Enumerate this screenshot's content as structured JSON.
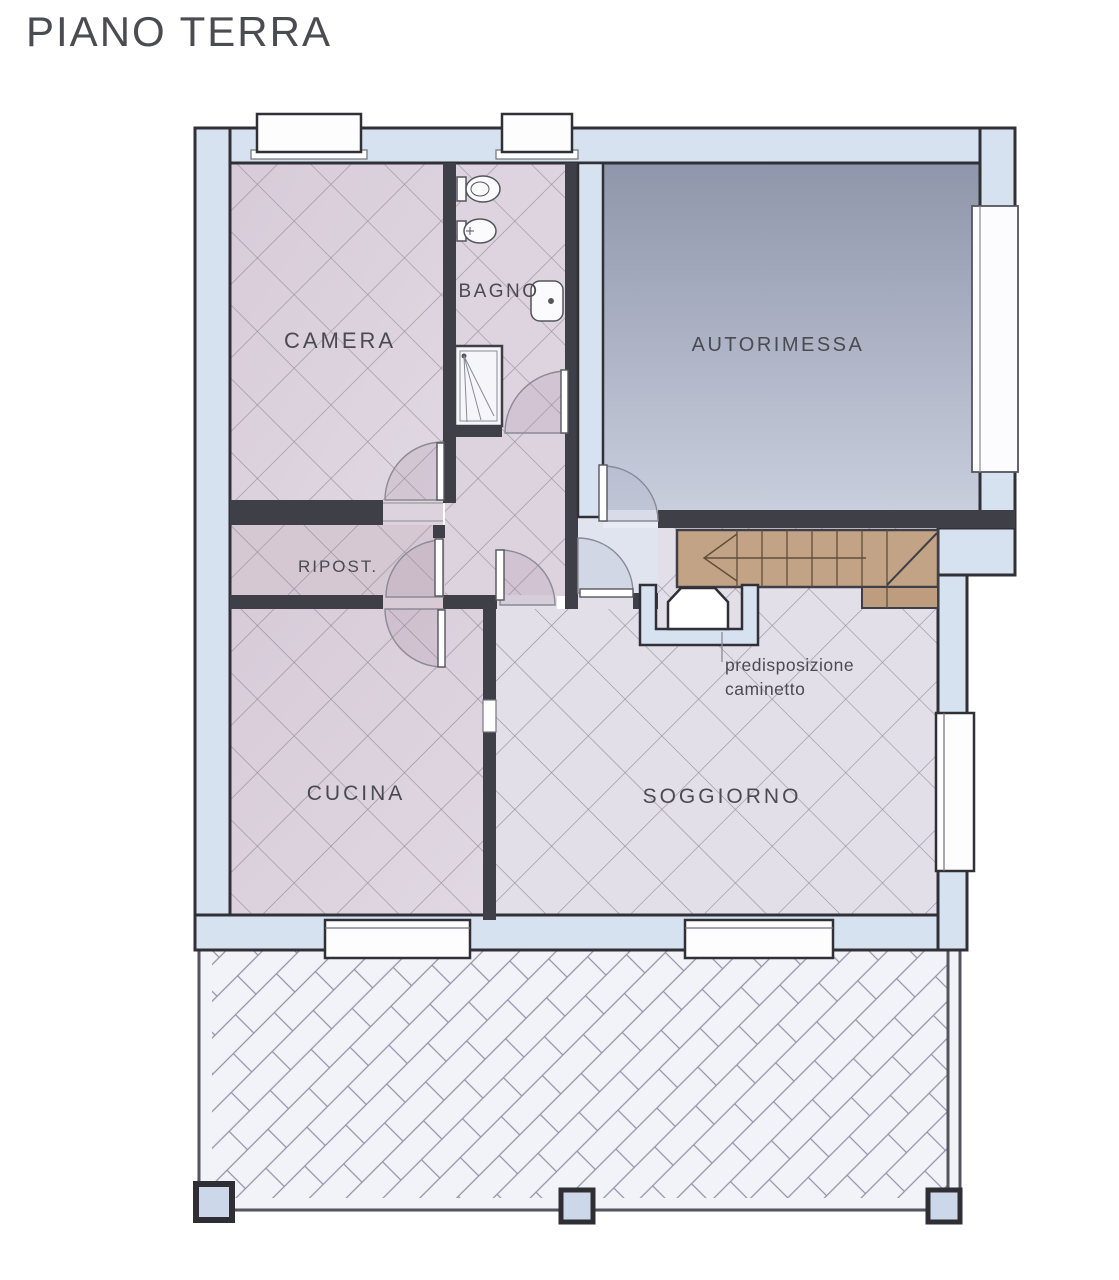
{
  "title": "PIANO TERRA",
  "floor_plan": {
    "rooms": {
      "camera": "CAMERA",
      "bagno": "BAGNO",
      "autorimessa": "AUTORIMESSA",
      "ripostiglio": "RIPOST.",
      "cucina": "CUCINA",
      "soggiorno": "SOGGIORNO"
    },
    "annotations": {
      "fireplace_note_line1": "predisposizione",
      "fireplace_note_line2": "caminetto"
    },
    "colors": {
      "wall_fill": "#d7e2f0",
      "wall_outline": "#303036",
      "interior_wall": "#3f3f47",
      "floor_pink": "#dcd2dc",
      "floor_mauve": "#d6c9d4",
      "floor_lavender": "#e3dfe9",
      "vestibule_floor": "#dfe4ef",
      "garage_gradient_top": "#8f96ab",
      "garage_gradient_bottom": "#c9cedd",
      "stairs_fill": "#c3a385",
      "terrace_background": "#eff1f8",
      "label_color": "#4a4a52"
    }
  }
}
